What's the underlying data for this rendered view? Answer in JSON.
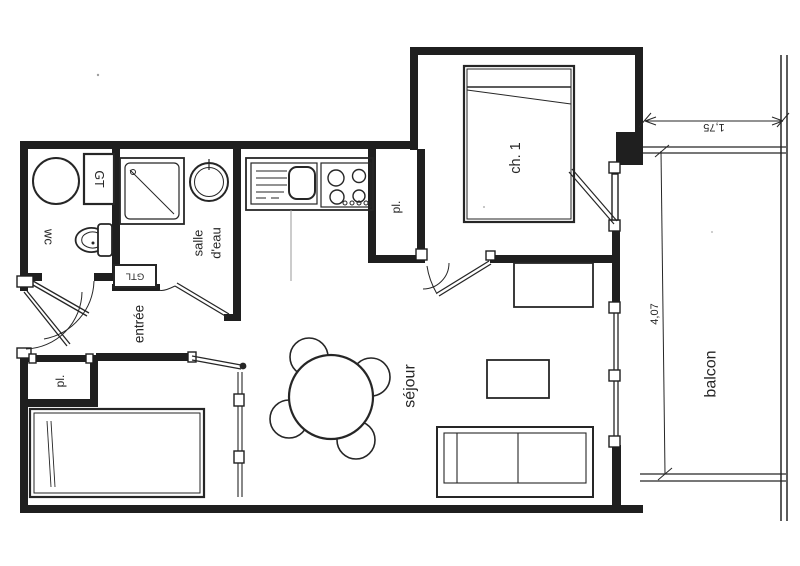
{
  "plan": {
    "type": "floor-plan",
    "labels": {
      "wc": "wc",
      "gt": "GT",
      "salle_deau_line1": "salle",
      "salle_deau_line2": "d'eau",
      "gtl": "GTL",
      "entree": "entrée",
      "placard_top": "pl.",
      "placard_bottom": "pl.",
      "chambre": "ch. 1",
      "sejour": "séjour",
      "balcon": "balcon"
    },
    "dimensions": {
      "balcony_width_m": "1,75",
      "balcony_depth_m": "4,07"
    },
    "colors": {
      "ink": "#262626",
      "paper": "#ffffff"
    }
  }
}
